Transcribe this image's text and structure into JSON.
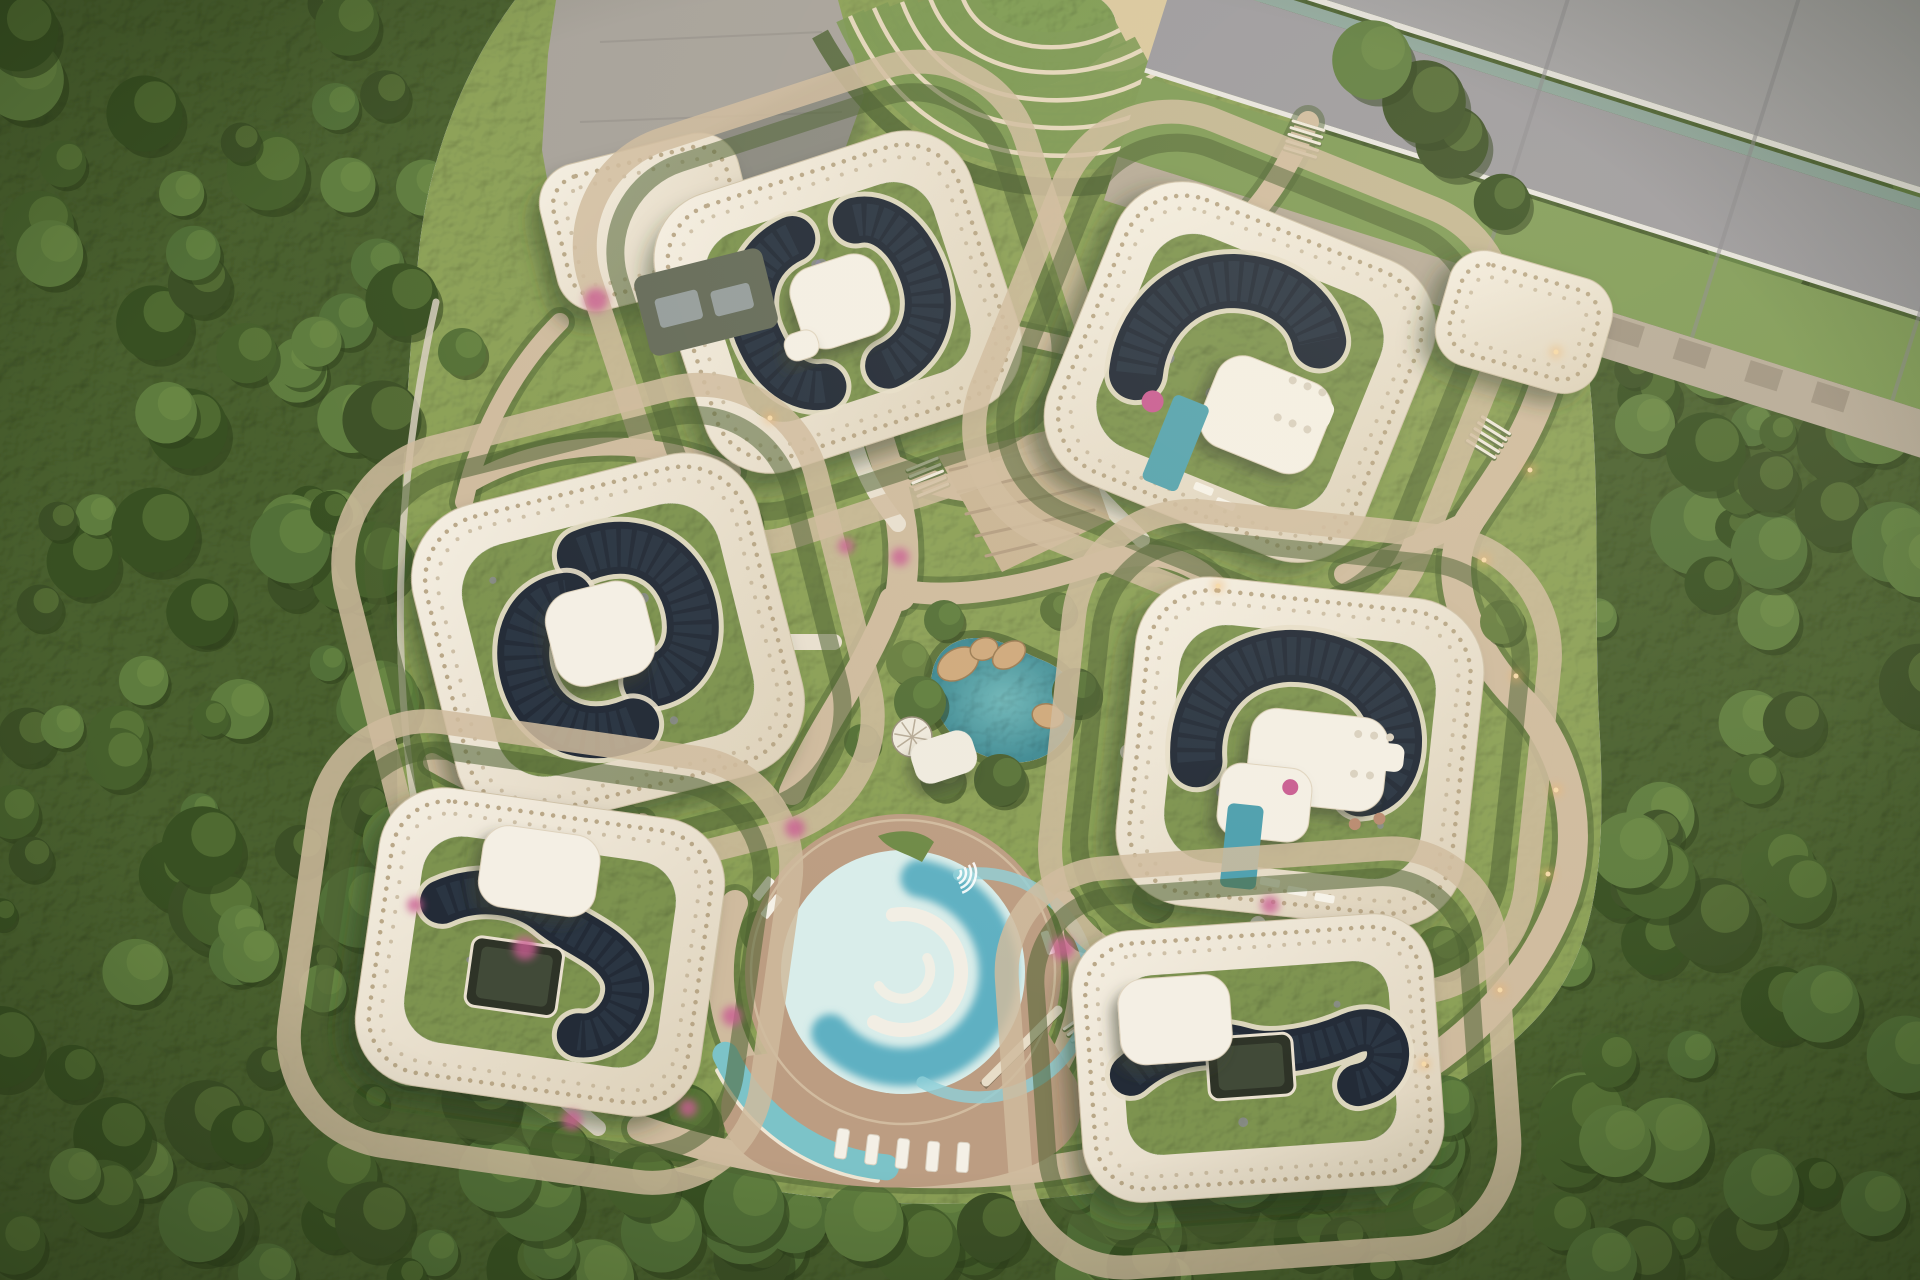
{
  "meta": {
    "description": "Top-down aerial rendering of an organic-shaped eco residential complex: seven cream buildings with perforated roof rims, green roofs with dark solar arrays, white penthouses, central garden with teal rock pond, circular swimming pool with deck, terraced entry landscape, highway at top right, dense forest all around",
    "canvas": {
      "width": 1920,
      "height": 1280
    }
  },
  "palette": {
    "forest_base": "#49602e",
    "forest_shade": "#2e3f1c",
    "forest_light": "#6e8a45",
    "site_green": "#8ba057",
    "lawn": "#7c9a51",
    "hedge": "#4c6131",
    "path_tan": "#cfbb9e",
    "path_light": "#e8dfcf",
    "plaza_gray": "#a7a29a",
    "road_asphalt": "#a5a3a6",
    "road_asphalt2": "#9b999d",
    "road_green": "#7e9a55",
    "sidewalk": "#b6aa97",
    "guardrail": "#8ea69c",
    "white_line": "#e8e5df",
    "shell_cream_1": "#f5efe3",
    "shell_cream_2": "#dcd0b8",
    "perf_dot": "#b5a383",
    "roof_green": "#7d9350",
    "solar_dark": "#232b37",
    "solar_line": "#323e4c",
    "solar_rim": "#e7dec9",
    "penthouse_white": "#f4efe4",
    "courtyard_dark": "#2e3327",
    "pool_deck": "#bc9d82",
    "pool_shallow": "#d9edea",
    "pool_deep": "#5fb0c2",
    "pool_mid": "#8fd0d8",
    "kid_pool": "#7cc3c8",
    "pond_teal": "#3f8a93",
    "pond_light": "#6fb7b9",
    "rock_tan": "#cfa97c",
    "flower_pink": "#c95d92",
    "light_warm": "#f0b26a",
    "sand": "#d9c79d",
    "terrace_line": "#e3d5ba",
    "terrace_band": "#7b9752",
    "lavender": "#8f86ae",
    "annex_dark": "#656b59",
    "skylight_gray": "#9aa3a3"
  },
  "forest": {
    "seed": 7,
    "clump_count": 150,
    "extra_left": 55,
    "extra_bottom": 45,
    "extra_right": 40,
    "clump_colors": [
      "#3c5026",
      "#46602c",
      "#527038",
      "#5e7c3e",
      "#385022"
    ],
    "highlight": "#7a9a4e"
  },
  "road": {
    "origin": [
      1320,
      -86
    ],
    "angle": 17.5,
    "len": 1180,
    "bands": [
      {
        "y": -260,
        "h": 340,
        "fill": "road_asphalt"
      },
      {
        "y": 80,
        "h": 6,
        "fill": "white_line"
      },
      {
        "y": 90,
        "h": 12,
        "fill": "guardrail"
      },
      {
        "y": 102,
        "h": 97,
        "fill": "road_asphalt2"
      },
      {
        "y": 199,
        "h": 5,
        "fill": "white_line"
      },
      {
        "y": 208,
        "h": 84,
        "fill": "road_green"
      },
      {
        "y": 292,
        "h": 46,
        "fill": "sidewalk"
      }
    ],
    "joints": [
      260,
      480,
      690,
      900
    ],
    "pads": [
      330,
      400,
      470,
      545,
      615
    ]
  },
  "site": {
    "outline": "M 418,260 C 428,150 470,60 515,0 L 1258,0 L 1312,64 C 1294,140 1330,196 1424,234 C 1502,266 1556,292 1584,336 C 1604,470 1592,600 1600,738 C 1606,864 1596,948 1544,1010 C 1488,1076 1400,1118 1300,1148 C 1160,1192 1000,1210 880,1202 C 720,1192 596,1158 518,1098 C 438,1036 400,936 398,818 C 394,636 402,430 418,260 Z"
  },
  "plaza": {
    "outline": "M 556,0 L 838,0 L 864,96 L 844,152 L 792,218 L 706,294 L 612,302 L 558,242 L 542,150 L 548,54 Z",
    "shadow": "M 690,142 L 858,62 L 868,128 L 800,230 L 704,298 L 660,240 Z",
    "joints": [
      "M 600,42 L 822,32",
      "M 580,122 L 842,112",
      "M 590,202 L 800,198"
    ]
  },
  "terraces": {
    "bands": [
      "M 850,16 Q 902,132 1012,152 Q 1122,168 1186,116",
      "M 874,8 Q 916,106 1014,124 Q 1112,140 1174,94",
      "M 902,2 Q 932,82 1016,97 Q 1100,110 1158,72",
      "M 930,-2 Q 952,56 1022,70 Q 1086,80 1142,50",
      "M 962,-4 Q 976,36 1032,46 Q 1078,52 1120,30"
    ],
    "hedge": "M 820,34 Q 892,164 1016,184 Q 1142,200 1208,138",
    "lawn": {
      "cx": 1005,
      "cy": 38,
      "rx": 112,
      "ry": 56,
      "rot": -8
    },
    "sand": {
      "cx": 1124,
      "cy": 30,
      "rx": 68,
      "ry": 40,
      "rot": -12
    }
  },
  "steps_plaza": {
    "outline": "M 938,456 L 1076,424 L 1110,520 L 1002,572 Z",
    "lines": [
      "M 950,470 L 1086,440",
      "M 958,492 L 1094,462",
      "M 966,514 L 1100,484",
      "M 976,536 L 1094,510",
      "M 986,556 L 1078,534"
    ]
  },
  "paths": {
    "tan": [
      {
        "d": "M 848,206 C 856,300 858,380 886,462 C 902,512 908,548 900,596",
        "w": 30
      },
      {
        "d": "M 896,468 C 958,498 1028,500 1082,470",
        "w": 24
      },
      {
        "d": "M 900,590 C 962,602 1042,582 1102,562 C 1152,546 1192,560 1216,586",
        "w": 22
      },
      {
        "d": "M 892,600 C 862,678 822,722 792,792",
        "w": 26
      },
      {
        "d": "M 1560,318 C 1546,420 1502,470 1470,520 C 1432,580 1480,660 1520,700 C 1560,740 1590,820 1562,900 C 1532,980 1470,1040 1400,1082",
        "w": 30
      },
      {
        "d": "M 1470,520 C 1424,542 1382,560 1344,574",
        "w": 20
      },
      {
        "d": "M 640,1128 C 782,1178 982,1192 1130,1152 C 1232,1126 1332,1106 1402,1084",
        "w": 26
      },
      {
        "d": "M 560,322 C 520,362 482,422 464,502",
        "w": 18
      },
      {
        "d": "M 1308,122 C 1290,162 1272,192 1250,216",
        "w": 22
      },
      {
        "d": "M 1002,332 C 1052,342 1092,352 1132,362",
        "w": 18
      },
      {
        "d": "M 472,482 C 542,442 642,432 732,472",
        "w": 18
      },
      {
        "d": "M 432,762 C 502,802 562,822 642,822",
        "w": 18
      },
      {
        "d": "M 735,903 A 180,180 0 0 0 882,1152",
        "w": 26
      },
      {
        "d": "M 1064,903 A 175,175 0 0 1 992,1130",
        "w": 24
      }
    ],
    "stems": [
      "M 856,448 C 866,480 880,502 898,524",
      "M 788,642 L 834,642",
      "M 1128,752 L 1182,752",
      "M 1258,924 L 1258,966",
      "M 1082,478 C 1102,500 1122,520 1142,540",
      "M 560,1096 L 598,1128"
    ],
    "fence": {
      "d": "M 436,302 C 398,470 390,640 414,800 C 428,900 470,1010 560,1092",
      "w": 7
    },
    "steps_sets": [
      [
        928,
        478,
        -22
      ],
      [
        1488,
        438,
        32
      ],
      [
        906,
        1148,
        10
      ],
      [
        1304,
        140,
        17
      ],
      [
        1086,
        1032,
        -35
      ]
    ]
  },
  "pond": {
    "outline": "M 934,700 C 924,664 944,638 976,638 C 1002,638 1022,652 1042,660 C 1068,670 1082,690 1074,718 C 1066,748 1040,766 1008,762 C 974,757 942,736 934,700 Z",
    "rocks": [
      [
        958,
        664,
        22,
        15,
        -30
      ],
      [
        984,
        649,
        14,
        11,
        -18
      ],
      [
        1009,
        655,
        18,
        12,
        -34
      ],
      [
        1048,
        716,
        16,
        12,
        14
      ]
    ],
    "shrubs": [
      [
        920,
        702,
        26
      ],
      [
        1076,
        692,
        24
      ],
      [
        1000,
        780,
        26
      ],
      [
        944,
        620,
        20
      ]
    ]
  },
  "spiral_stair": {
    "cx": 912,
    "cy": 737,
    "r": 20
  },
  "canopy": {
    "cx": 944,
    "cy": 757,
    "w": 64,
    "h": 44,
    "rot": -18
  },
  "pool": {
    "cx": 903,
    "cy": 972,
    "deck_r": 158,
    "r": 122,
    "deck_blob": "M 748,1056 C 700,1100 718,1158 790,1176 C 862,1192 942,1192 1012,1172 C 1072,1156 1092,1120 1076,1080 L 1040,1020 Z",
    "deep": {
      "r": 95,
      "a0": 280,
      "a1": 140,
      "large": 1,
      "sweep": 1,
      "w": 38
    },
    "mid": {
      "r": 112,
      "a0": 300,
      "a1": 80,
      "large": 1,
      "sweep": 1,
      "w": 12
    },
    "isl1": {
      "r": 58,
      "a0": 120,
      "a1": 260,
      "large": 1,
      "sweep": 0,
      "w": 14
    },
    "isl2": {
      "r": 28,
      "a0": 150,
      "a1": 330,
      "large": 0,
      "sweep": 0,
      "w": 10
    },
    "kid": {
      "r": 196,
      "a0": 95,
      "a1": 155,
      "large": 0,
      "sweep": 1,
      "w": 26
    },
    "kid_edge": {
      "r": 210,
      "a0": 97,
      "a1": 152,
      "large": 0,
      "sweep": 1,
      "w": 5
    },
    "bridge": "M 986,1082 L 1058,1010",
    "steps_fan": [
      955,
      873
    ],
    "planter": "M 878,836 C 898,828 922,830 934,842 L 922,862 C 904,852 888,850 878,836 Z",
    "loungers_sw": [
      [
        838,
        1128
      ],
      [
        868,
        1134
      ],
      [
        898,
        1138
      ],
      [
        928,
        1141
      ],
      [
        958,
        1142
      ]
    ],
    "loungers_w": [
      [
        752,
        896,
        -52
      ],
      [
        760,
        914,
        -52
      ]
    ],
    "lounger_e": [
      1048,
      930,
      72
    ]
  },
  "buildings": [
    {
      "name": "annex-northwest",
      "cx": 648,
      "cy": 222,
      "w": 204,
      "h": 150,
      "rot": -14,
      "rx": 40,
      "rings": false,
      "roof": false,
      "solar": [],
      "pent": [],
      "deco": []
    },
    {
      "name": "building-top-center",
      "cx": 838,
      "cy": 302,
      "w": 330,
      "h": 290,
      "rot": -18,
      "rx": 68,
      "rings": true,
      "roof": true,
      "solar": [
        {
          "d": "M -24,-74 C -70,-68 -92,-28 -86,14 C -82,48 -64,72 -40,76",
          "w": 46
        },
        {
          "d": "M 28,76 C 74,70 94,30 88,-12 C 84,-46 66,-70 42,-72",
          "w": 46
        }
      ],
      "pent": [
        {
          "x": 2,
          "y": 0,
          "w": 92,
          "h": 84,
          "r": 26
        },
        {
          "x": -48,
          "y": 30,
          "w": 34,
          "h": 28,
          "r": 12
        }
      ],
      "deco": []
    },
    {
      "name": "building-top-right",
      "cx": 1240,
      "cy": 372,
      "w": 340,
      "h": 320,
      "rot": 22,
      "rx": 72,
      "rings": true,
      "roof": true,
      "solar": [
        {
          "d": "M -96,40 C -110,-8 -90,-62 -40,-82 C 4,-98 44,-86 62,-58",
          "w": 54
        }
      ],
      "pent": [
        {
          "x": 40,
          "y": 30,
          "w": 122,
          "h": 96,
          "r": 28
        }
      ],
      "deco": [
        {
          "t": "rect",
          "x": -52,
          "y": 44,
          "w": 38,
          "h": 92,
          "r": 6,
          "fill": "#55a3ae"
        },
        {
          "t": "rect",
          "x": 44,
          "y": -6,
          "w": 58,
          "h": 28,
          "r": 9,
          "fill": "#f4efe4"
        },
        {
          "t": "dot",
          "x": 52,
          "y": -12,
          "r": 4,
          "fill": "#d9d0bf"
        },
        {
          "t": "dot",
          "x": 68,
          "y": -12,
          "r": 4,
          "fill": "#d9d0bf"
        },
        {
          "t": "dot",
          "x": 84,
          "y": -12,
          "r": 4,
          "fill": "#d9d0bf"
        },
        {
          "t": "dot",
          "x": 52,
          "y": 28,
          "r": 4,
          "fill": "#d9d0bf"
        },
        {
          "t": "dot",
          "x": 68,
          "y": 28,
          "r": 4,
          "fill": "#d9d0bf"
        },
        {
          "t": "dot",
          "x": 84,
          "y": 28,
          "r": 4,
          "fill": "#d9d0bf"
        },
        {
          "t": "rect",
          "x": 0,
          "y": 118,
          "w": 20,
          "h": 8,
          "r": 2,
          "fill": "#f6f2e8"
        },
        {
          "t": "rect",
          "x": 26,
          "y": 124,
          "w": 20,
          "h": 8,
          "r": 2,
          "fill": "#f6f2e8"
        },
        {
          "t": "dot",
          "x": -70,
          "y": 60,
          "r": 11,
          "fill": "#c95d92"
        }
      ]
    },
    {
      "name": "building-left-middle",
      "cx": 608,
      "cy": 640,
      "w": 356,
      "h": 330,
      "rot": -14,
      "rx": 76,
      "rings": true,
      "roof": true,
      "solar": [
        {
          "d": "M -4,-88 C 52,-96 90,-62 88,-10 C 86,30 62,54 30,50",
          "w": 52
        },
        {
          "d": "M 4,88 C -52,96 -90,62 -88,10 C -86,-30 -62,-54 -30,-50",
          "w": 52
        }
      ],
      "pent": [
        {
          "x": -6,
          "y": -8,
          "w": 102,
          "h": 96,
          "r": 30
        }
      ],
      "deco": []
    },
    {
      "name": "building-right-middle",
      "cx": 1300,
      "cy": 752,
      "w": 350,
      "h": 330,
      "rot": 6,
      "rx": 74,
      "rings": true,
      "roof": true,
      "solar": [
        {
          "d": "M -102,20 C -112,-34 -82,-84 -24,-94 C 34,-102 86,-74 94,-24 C 98,6 86,28 64,32",
          "w": 52
        }
      ],
      "pent": [
        {
          "x": 18,
          "y": 6,
          "w": 138,
          "h": 94,
          "r": 26
        },
        {
          "x": -30,
          "y": 54,
          "w": 92,
          "h": 74,
          "r": 22
        }
      ],
      "deco": [
        {
          "t": "rect",
          "x": -66,
          "y": 58,
          "w": 36,
          "h": 84,
          "r": 6,
          "fill": "#4d9fae"
        },
        {
          "t": "rect",
          "x": 48,
          "y": -18,
          "w": 56,
          "h": 28,
          "r": 9,
          "fill": "#f4efe4"
        },
        {
          "t": "dot",
          "x": 56,
          "y": -24,
          "r": 4,
          "fill": "#d9d0bf"
        },
        {
          "t": "dot",
          "x": 72,
          "y": -24,
          "r": 4,
          "fill": "#d9d0bf"
        },
        {
          "t": "dot",
          "x": 88,
          "y": -24,
          "r": 4,
          "fill": "#d9d0bf"
        },
        {
          "t": "dot",
          "x": 56,
          "y": 16,
          "r": 4,
          "fill": "#d9d0bf"
        },
        {
          "t": "dot",
          "x": 72,
          "y": 16,
          "r": 4,
          "fill": "#d9d0bf"
        },
        {
          "t": "rect",
          "x": -26,
          "y": 128,
          "w": 20,
          "h": 8,
          "r": 2,
          "fill": "#f6f2e8",
          "rot": 4
        },
        {
          "t": "rect",
          "x": 2,
          "y": 134,
          "w": 20,
          "h": 8,
          "r": 2,
          "fill": "#f6f2e8",
          "rot": 4
        },
        {
          "t": "rect",
          "x": 30,
          "y": 138,
          "w": 20,
          "h": 8,
          "r": 2,
          "fill": "#f6f2e8",
          "rot": 4
        },
        {
          "t": "dot",
          "x": 62,
          "y": 66,
          "r": 6,
          "fill": "#b98a70"
        },
        {
          "t": "dot",
          "x": 86,
          "y": 58,
          "r": 6,
          "fill": "#b98a70"
        },
        {
          "t": "dot",
          "x": -6,
          "y": 36,
          "r": 8,
          "fill": "#c95d92"
        }
      ]
    },
    {
      "name": "building-bottom-left",
      "cx": 540,
      "cy": 952,
      "w": 348,
      "h": 300,
      "rot": 8,
      "rx": 66,
      "rings": true,
      "roof": true,
      "solar": [
        {
          "d": "M -104,-36 C -70,-58 -24,-58 6,-38 C 32,-22 66,-18 84,6 C 96,22 94,46 80,62 C 72,72 60,77 50,77",
          "w": 44
        }
      ],
      "courtyard": {
        "x": -22,
        "y": 28,
        "w": 92,
        "h": 70,
        "r": 10
      },
      "pent": [
        {
          "x": -12,
          "y": -80,
          "w": 118,
          "h": 82,
          "r": 26
        }
      ],
      "deco": []
    },
    {
      "name": "building-bottom-right",
      "cx": 1258,
      "cy": 1058,
      "w": 362,
      "h": 272,
      "rot": -4,
      "rx": 60,
      "rings": true,
      "roof": true,
      "solar": [
        {
          "d": "M -128,8 C -94,-18 -50,-24 -12,-10 C 16,0 62,-6 94,-18 C 118,-26 132,-12 130,6 C 128,22 116,32 98,34",
          "w": 42
        }
      ],
      "courtyard": {
        "x": -8,
        "y": 8,
        "w": 86,
        "h": 62,
        "r": 10
      },
      "pent": [
        {
          "x": -80,
          "y": -44,
          "w": 112,
          "h": 86,
          "r": 26
        }
      ],
      "deco": []
    },
    {
      "name": "pavilion-road-entry",
      "cx": 1524,
      "cy": 322,
      "w": 168,
      "h": 118,
      "rot": 16,
      "rx": 36,
      "rings": false,
      "roof": false,
      "solar": [],
      "pent": [],
      "deco": []
    }
  ],
  "annex_dark": {
    "cx": 706,
    "cy": 302,
    "w": 132,
    "h": 82,
    "rot": -14,
    "skylights": [
      [
        -28,
        0,
        44,
        30
      ],
      [
        26,
        4,
        40,
        26
      ]
    ]
  },
  "interior_trees": [
    [
      735,
      520,
      26
    ],
    [
      700,
      578,
      20
    ],
    [
      908,
      662,
      22
    ],
    [
      942,
      778,
      22
    ],
    [
      862,
      742,
      18
    ],
    [
      1122,
      470,
      22
    ],
    [
      1152,
      900,
      20
    ],
    [
      1082,
      932,
      18
    ],
    [
      622,
      822,
      20
    ],
    [
      762,
      932,
      22
    ],
    [
      462,
      352,
      24
    ],
    [
      1440,
      952,
      26
    ],
    [
      1502,
      622,
      22
    ],
    [
      1182,
      232,
      20
    ],
    [
      1000,
      786,
      18
    ],
    [
      1058,
      610,
      18
    ]
  ],
  "tree_rows": {
    "road": [
      [
        1190,
        238
      ],
      [
        1246,
        258
      ],
      [
        1302,
        284
      ],
      [
        1358,
        308
      ],
      [
        1645,
        424
      ],
      [
        1706,
        452
      ],
      [
        1768,
        482
      ],
      [
        1830,
        512
      ],
      [
        1892,
        542
      ],
      [
        1918,
        562
      ]
    ],
    "bottom": [
      [
        560,
        1152
      ],
      [
        642,
        1182
      ],
      [
        744,
        1206
      ],
      [
        864,
        1222
      ],
      [
        992,
        1228
      ],
      [
        1122,
        1208
      ],
      [
        1242,
        1172
      ],
      [
        1342,
        1132
      ],
      [
        1444,
        1106
      ],
      [
        680,
        1122
      ],
      [
        480,
        1100
      ]
    ],
    "left": [
      [
        402,
        300
      ],
      [
        382,
        420
      ],
      [
        374,
        560
      ],
      [
        380,
        700
      ],
      [
        398,
        840
      ],
      [
        432,
        980
      ],
      [
        474,
        1062
      ]
    ],
    "ne": [
      [
        1452,
        142
      ],
      [
        1502,
        202
      ],
      [
        1424,
        102
      ],
      [
        1372,
        60
      ]
    ]
  },
  "flowers": [
    [
      596,
      300,
      12
    ],
    [
      525,
      948,
      12
    ],
    [
      795,
      828,
      10
    ],
    [
      1063,
      948,
      12
    ],
    [
      732,
      1016,
      10
    ],
    [
      900,
      557,
      9
    ],
    [
      846,
      546,
      8
    ],
    [
      1270,
      905,
      9
    ],
    [
      572,
      1120,
      10
    ],
    [
      688,
      1108,
      9
    ],
    [
      415,
      905,
      8
    ]
  ],
  "lights": [
    [
      1556,
      352
    ],
    [
      1530,
      470
    ],
    [
      1484,
      560
    ],
    [
      1516,
      676
    ],
    [
      1556,
      790
    ],
    [
      1548,
      874
    ],
    [
      1500,
      990
    ],
    [
      1424,
      1064
    ],
    [
      1218,
      586
    ],
    [
      770,
      418
    ]
  ]
}
